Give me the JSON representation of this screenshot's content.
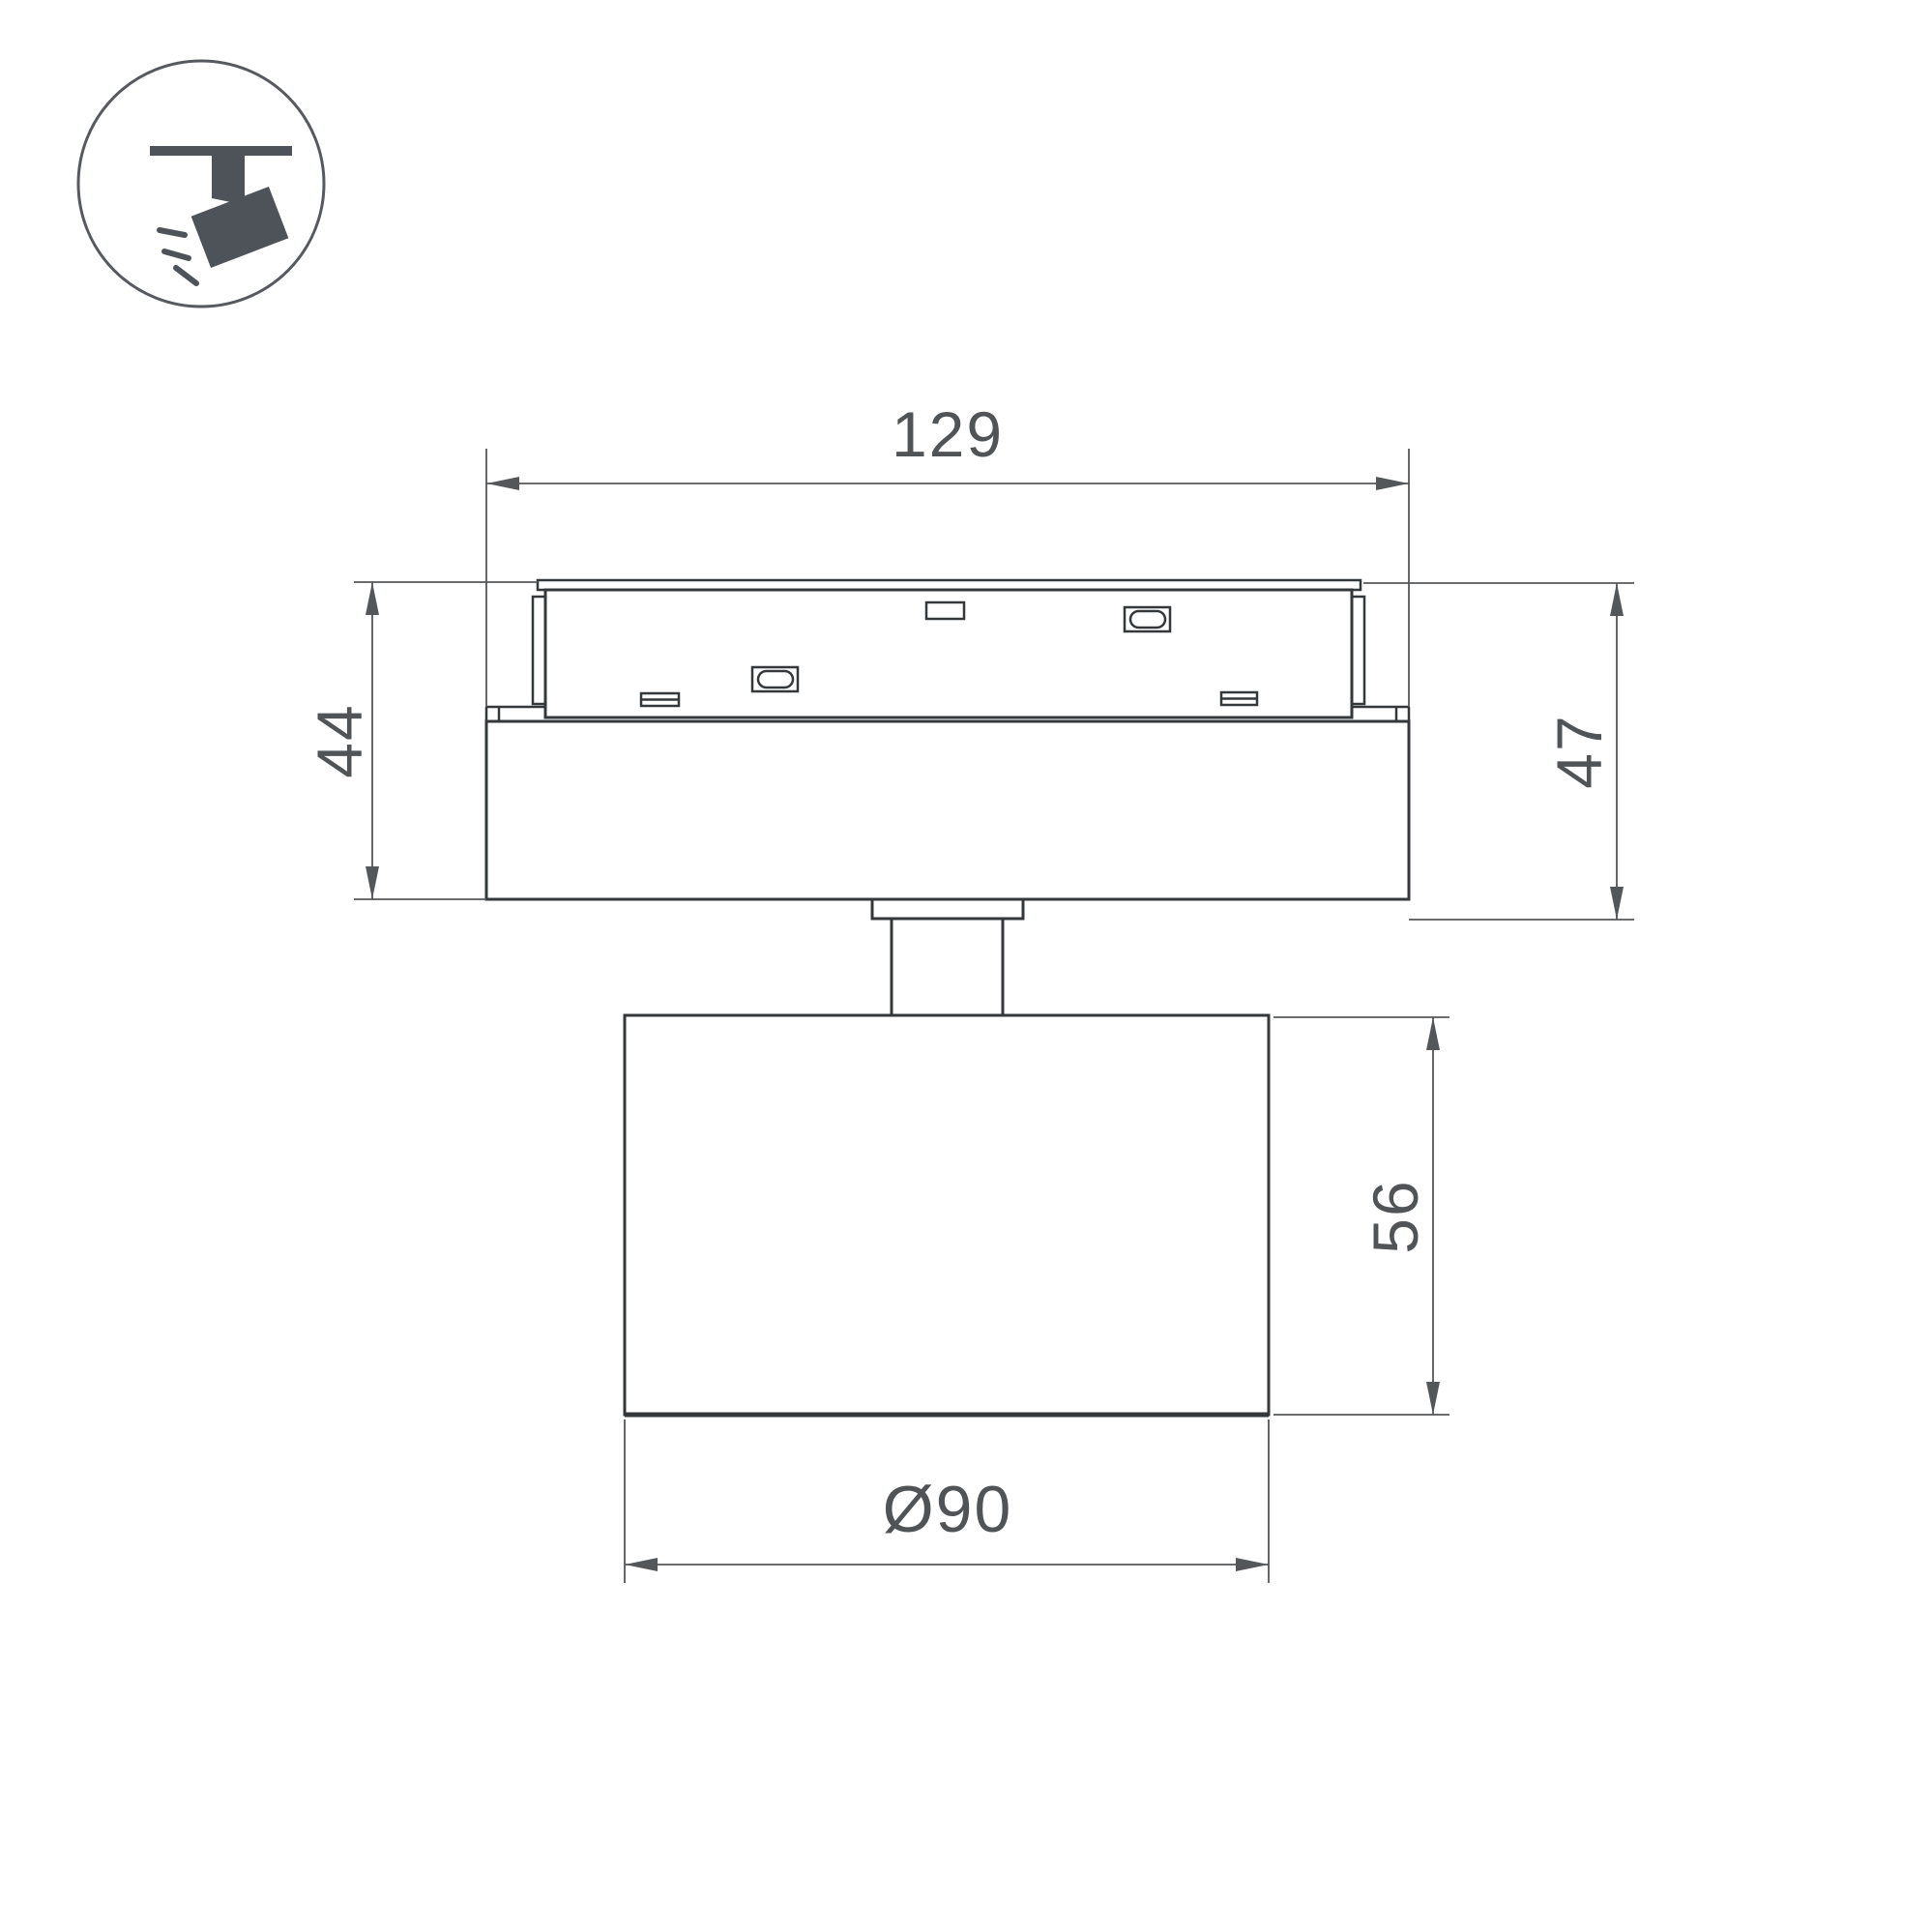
{
  "page": {
    "background_color": "#ffffff",
    "type": "technical-dimension-drawing",
    "subject": "track-mounted spotlight luminaire"
  },
  "icon": {
    "name": "track-spotlight-icon",
    "shape_color": "#4d5358",
    "circle_outline_color": "#56595e"
  },
  "drawing": {
    "device_line_color": "#35383b",
    "dimension_line_color": "#54575a",
    "label_color": "#515456",
    "dimensions": {
      "track_width": {
        "value": "129"
      },
      "base_height_left": {
        "value": "44"
      },
      "overall_height_right": {
        "value": "47"
      },
      "head_height": {
        "value": "56"
      },
      "head_diameter": {
        "value": "Ø90"
      }
    }
  }
}
